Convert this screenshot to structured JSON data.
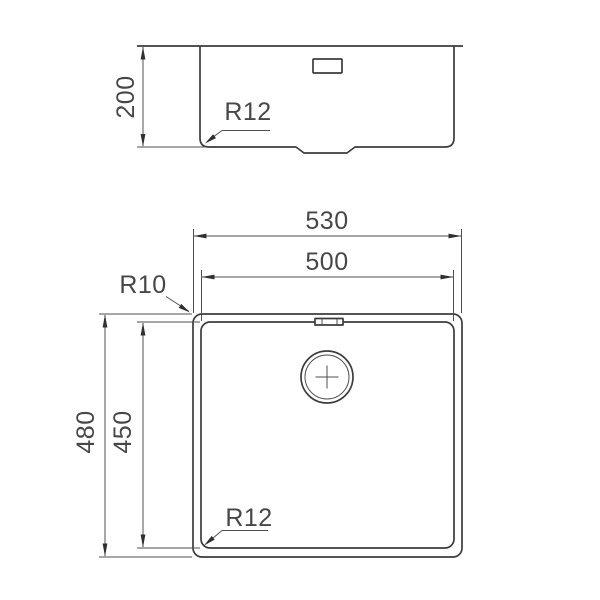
{
  "side_view": {
    "depth_dim": "200",
    "bottom_corner_radius": "R12"
  },
  "plan_view": {
    "outer_width_dim": "530",
    "inner_width_dim": "500",
    "outer_length_dim": "480",
    "inner_length_dim": "450",
    "outer_corner_radius": "R10",
    "inner_corner_radius": "R12"
  },
  "colors": {
    "background": "#ffffff",
    "object_line": "#3c3c3c",
    "dimension_line": "#4f4f4f",
    "text": "#474747"
  }
}
